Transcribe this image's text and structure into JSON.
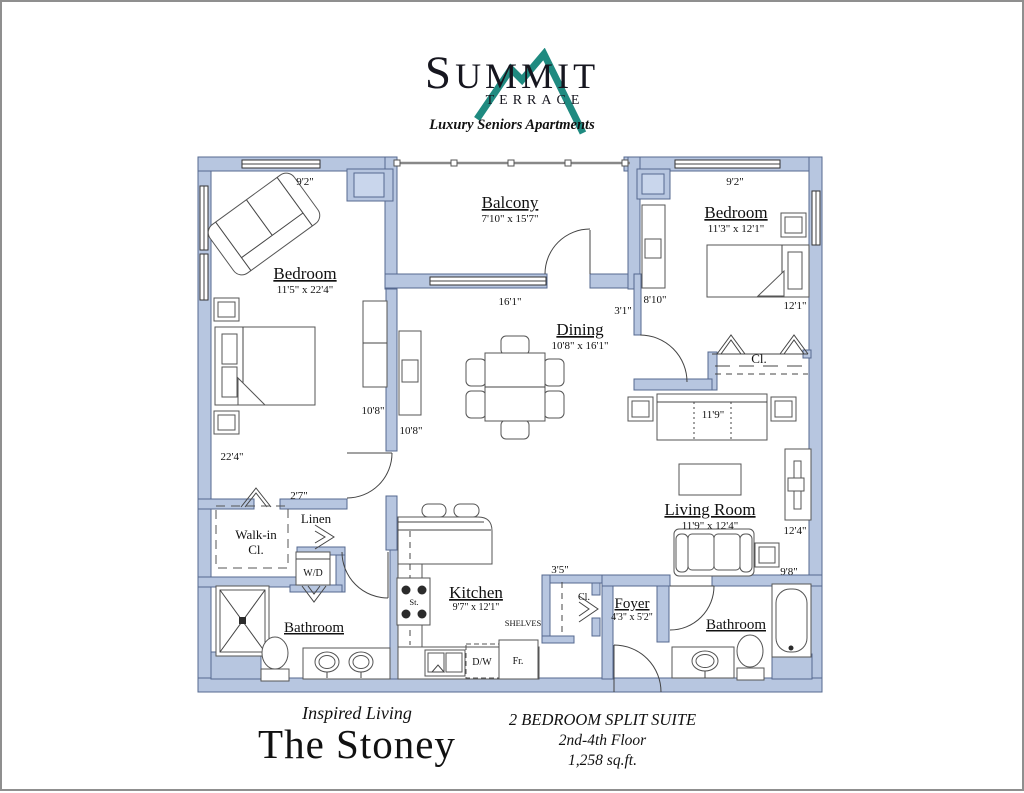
{
  "palette": {
    "wall_fill": "#b7c6e0",
    "wall_stroke": "#55688f",
    "line_color": "#444444",
    "logo_teal": "#1f8a80",
    "page_border": "#8f8f8f"
  },
  "logo": {
    "summit": "SUMMIT",
    "terrace": "TERRACE",
    "tagline": "Luxury Seniors Apartments",
    "mountain_icon": "teal mountain peaks"
  },
  "rooms": {
    "balcony": {
      "label": "Balcony",
      "dims": "7'10\" x 15'7\""
    },
    "bedroom_left": {
      "label": "Bedroom",
      "dims": "11'5\" x 22'4\""
    },
    "bedroom_right": {
      "label": "Bedroom",
      "dims": "11'3\" x 12'1\""
    },
    "dining": {
      "label": "Dining",
      "dims": "10'8\" x 16'1\""
    },
    "living": {
      "label": "Living Room",
      "dims": "11'9\" x 12'4\""
    },
    "kitchen": {
      "label": "Kitchen",
      "dims": "9'7\" x 12'1\""
    },
    "foyer": {
      "label": "Foyer",
      "dims": "4'3\" x 5'2\""
    },
    "bath_left": {
      "label": "Bathroom"
    },
    "bath_right": {
      "label": "Bathroom"
    },
    "walkin": {
      "line1": "Walk-in",
      "line2": "Cl."
    },
    "linen": {
      "label": "Linen"
    },
    "wd": {
      "label": "W/D"
    },
    "closet_bedroom": {
      "label": "Cl."
    },
    "closet_foyer": {
      "label": "Cl."
    },
    "shelves": {
      "label": "SHELVES"
    },
    "stove": {
      "label": "St."
    },
    "dishwasher": {
      "label": "D/W"
    },
    "fridge": {
      "label": "Fr."
    }
  },
  "dims": {
    "top_left": "9'2\"",
    "top_right": "9'2\"",
    "left_height": "22'4\"",
    "partition_a": "10'8\"",
    "partition_b": "10'8\"",
    "balcony_width": "16'1\"",
    "hall": "3'1\"",
    "br_left": "8'10\"",
    "br_bottom": "12'1\"",
    "closet_sofa": "11'9\"",
    "lr_right": "12'4\"",
    "lr_right2": "9'8\"",
    "linen_top": "2'7\"",
    "foyer_closet": "3'5\""
  },
  "footer": {
    "tagline": "Inspired Living",
    "name": "The Stoney",
    "type": "2 BEDROOM SPLIT SUITE",
    "floor": "2nd-4th Floor",
    "area": "1,258 sq.ft."
  }
}
